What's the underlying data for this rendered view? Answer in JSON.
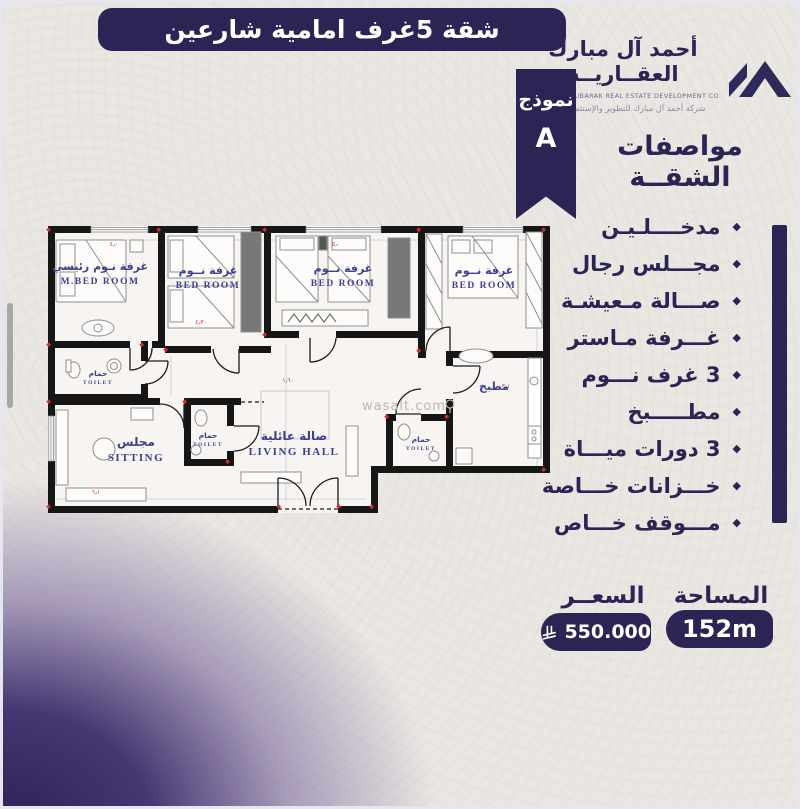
{
  "banner": {
    "title": "شقة 5غرف  امامية شارعين"
  },
  "logo": {
    "name_line1": "أحمد آل مبارك",
    "name_line2": "العقــاريــة",
    "english": "AHMED AL MUBARAK REAL ESTATE DEVELOPMENT CO.",
    "tagline": "شركة أحمد آل مبارك للتطوير والإستثمار العقاري"
  },
  "model_ribbon": {
    "label": "نموذج",
    "value": "A"
  },
  "specs": {
    "heading": "مواصفات الشقــة",
    "items": [
      "مدخــــلـيـن",
      "مجـــلس رجال",
      "صـــالة مـعيشـة",
      "غـــرفة مـاستر",
      "3 غرف نـــوم",
      "مطـــــبخ",
      "3 دورات ميـــاة",
      "خـــزانات خـــاصة",
      "مـــوقف خـــاص"
    ]
  },
  "footer": {
    "area_label": "المساحة",
    "area_value": "152m",
    "price_label": "السعــر",
    "price_value": "550.000",
    "currency_icon": "saudi-riyal-symbol"
  },
  "floorplan": {
    "watermark": "wasalt.com",
    "rooms": {
      "master": {
        "ar": "غرفة نـوم رئيسي",
        "en": "M.BED ROOM"
      },
      "bed2": {
        "ar": "غرفة نــوم",
        "en": "BED ROOM"
      },
      "bed3": {
        "ar": "غرفة نــوم",
        "en": "BED ROOM"
      },
      "bed4": {
        "ar": "غرفة نــوم",
        "en": "BED ROOM"
      },
      "kitchen": {
        "ar": "مطبخ"
      },
      "sitting": {
        "ar": "مجلس",
        "en": "SITTING"
      },
      "living": {
        "ar": "صالة عائلية",
        "en": "LIVING HALL"
      },
      "toilet1": {
        "ar": "حمام",
        "en": "TOILET"
      },
      "toilet2": {
        "ar": "حمام",
        "en": "TOILET"
      },
      "toilet3": {
        "ar": "حمام",
        "en": "TOILET"
      }
    },
    "dims": [
      "٤٫٠",
      "٥٫٠",
      "٤٫٣٠",
      "١٫٦٠",
      "٣٫١",
      "٦٫١"
    ]
  },
  "colors": {
    "primary": "#2b2454",
    "plan_label": "#3c3f92",
    "background": "#eae6e2"
  }
}
